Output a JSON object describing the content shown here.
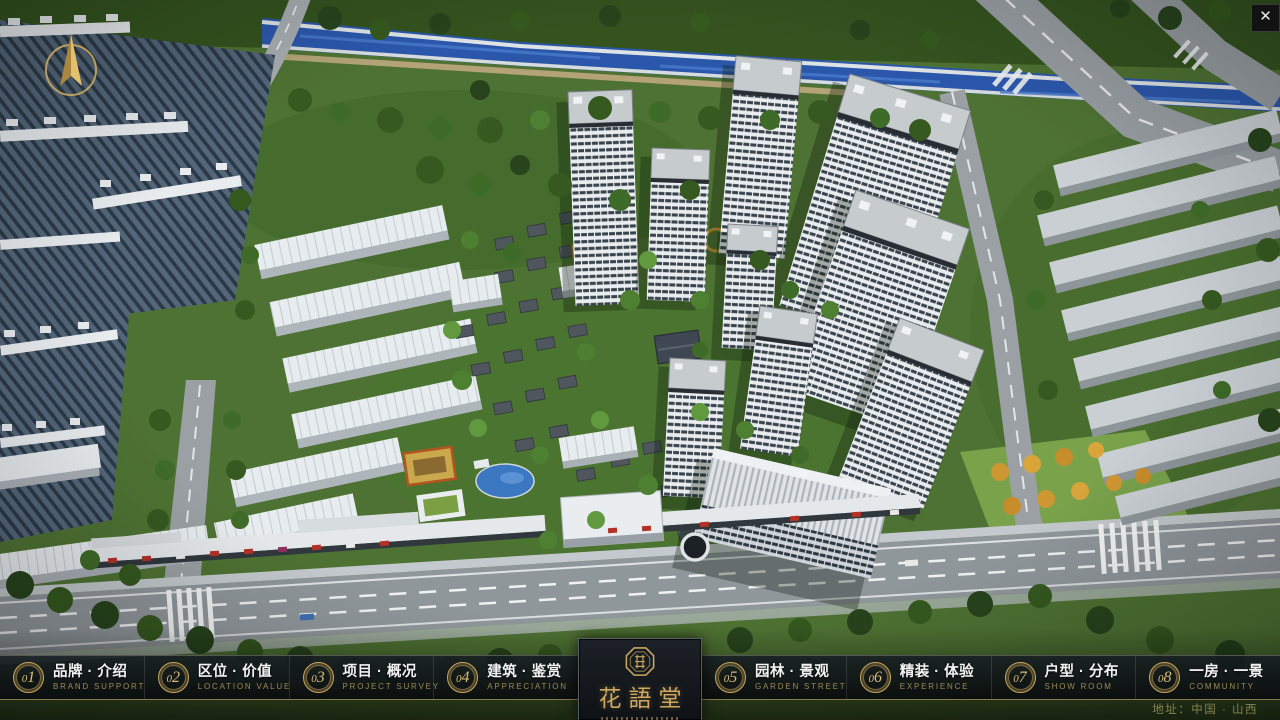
{
  "app": {
    "accent_gold": "#c9a75f",
    "navbar_bg": "#0b0f13",
    "close_icon": "✕"
  },
  "nav": {
    "items": [
      {
        "num": "01",
        "label": "品牌 · 介绍",
        "sub": "BRAND SUPPORT"
      },
      {
        "num": "02",
        "label": "区位 · 价值",
        "sub": "LOCATION VALUE"
      },
      {
        "num": "03",
        "label": "项目 · 概况",
        "sub": "PROJECT SURVEY"
      },
      {
        "num": "04",
        "label": "建筑 · 鉴赏",
        "sub": "APPRECIATION"
      },
      {
        "num": "05",
        "label": "园林 · 景观",
        "sub": "GARDEN STREET"
      },
      {
        "num": "06",
        "label": "精装 · 体验",
        "sub": "EXPERIENCE"
      },
      {
        "num": "07",
        "label": "户型 · 分布",
        "sub": "SHOW ROOM"
      },
      {
        "num": "08",
        "label": "一房 · 一景",
        "sub": "COMMUNITY"
      }
    ]
  },
  "logo": {
    "name": "花語堂"
  },
  "footer": {
    "address": "地址：中国 · 山西"
  }
}
